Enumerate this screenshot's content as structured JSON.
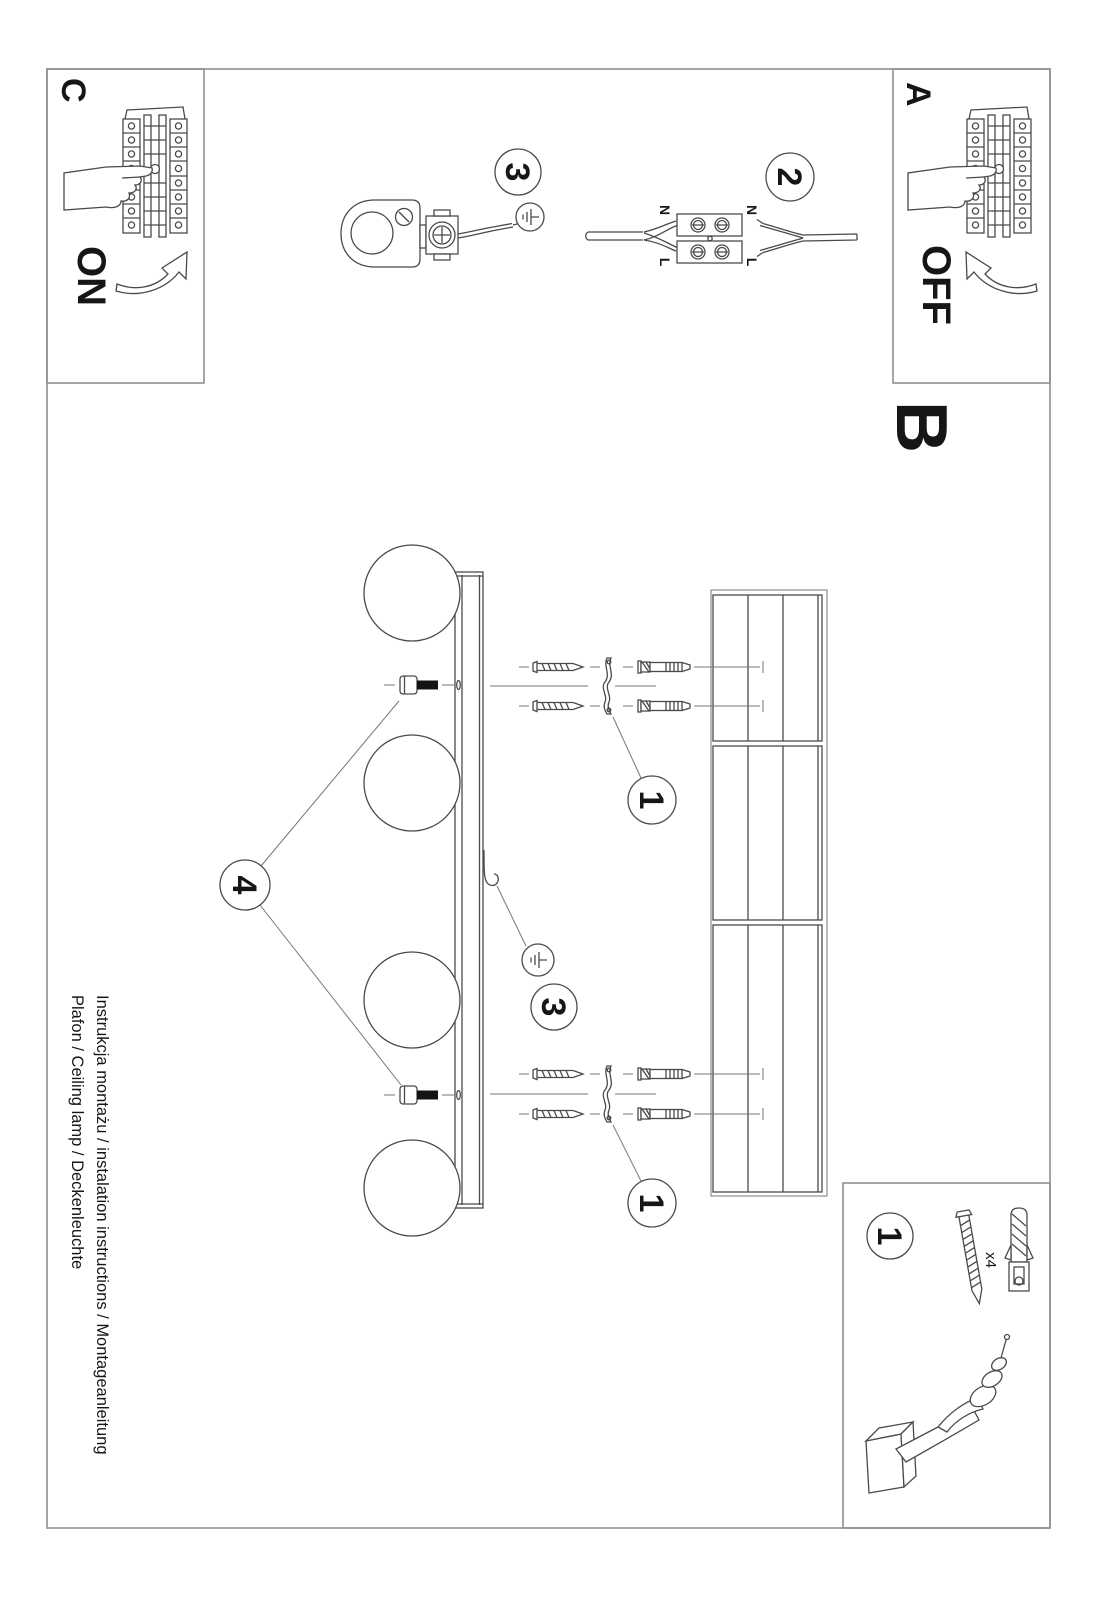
{
  "document": {
    "title_line1": "Instrukcja montażu / instalation instructions / Montageanleitung",
    "title_line2": "Plafon / Ceiling lamp / Deckenleuchte"
  },
  "sections": {
    "a": "A",
    "b": "B",
    "c": "C"
  },
  "power": {
    "on": "ON",
    "off": "OFF"
  },
  "steps": {
    "s1": "1",
    "s2": "2",
    "s3": "3",
    "s4": "4"
  },
  "wiring": {
    "neutral": "N",
    "live": "L"
  },
  "hardware": {
    "screw_plug_qty": "x4"
  },
  "figures": {
    "breaker": "circuit-breaker-panel",
    "hand": "pointing-hand",
    "arrow": "curved-arrow",
    "terminal": "terminal-block-connector",
    "holder": "lamp-holder-with-terminal",
    "ground": "earth-ground-symbol",
    "lamp": "ceiling-bar-with-4-globes",
    "ceiling": "ceiling-planks",
    "screw": "wood-screw",
    "plug": "wall-plug",
    "bracket": "mounting-bracket",
    "drill": "power-drill"
  },
  "colors": {
    "line": "#4a4a4a",
    "border": "#8f8f8f",
    "black": "#141414",
    "bg": "#ffffff"
  }
}
